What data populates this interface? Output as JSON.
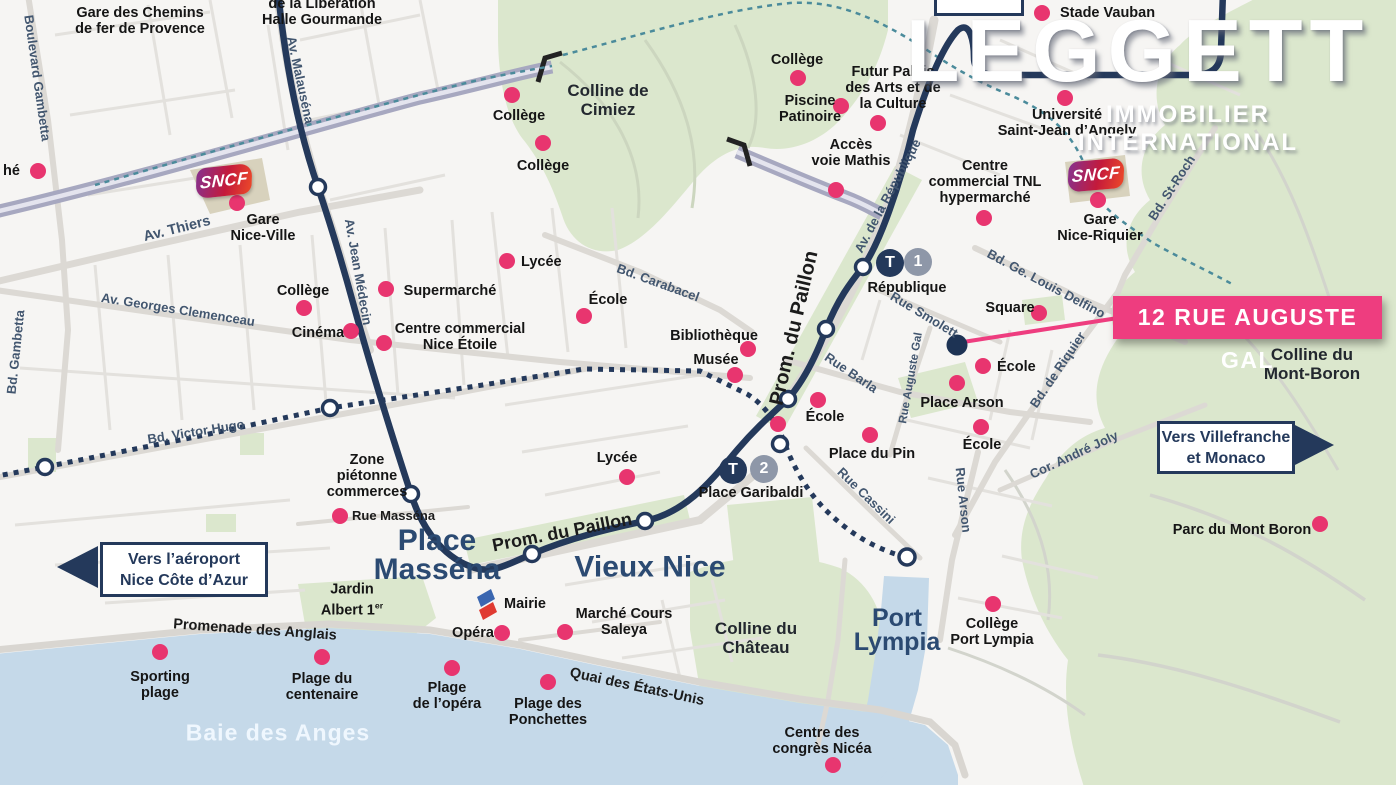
{
  "brand": {
    "logo": "LEGGETT",
    "tagline": "IMMOBILIER  INTERNATIONAL"
  },
  "callout": {
    "label": "12 RUE AUGUSTE GAL"
  },
  "direction_signs": [
    {
      "lines": [
        "Vers l’aéroport",
        "Nice Côte d’Azur"
      ],
      "arrow": "left"
    },
    {
      "lines": [
        "Vers Villefranche",
        "et Monaco"
      ],
      "arrow": "right"
    }
  ],
  "rail": [
    {
      "logo": "SNCF"
    },
    {
      "logo": "SNCF"
    }
  ],
  "tram_stations": [
    {
      "line_letter": "T",
      "line_number": "1",
      "name": "République",
      "badge_x": 890,
      "badge_y": 263,
      "num_x": 918,
      "num_y": 262,
      "label_x": 907,
      "label_y": 288
    },
    {
      "line_letter": "T",
      "line_number": "2",
      "name": "Place Garibaldi",
      "badge_x": 733,
      "badge_y": 470,
      "num_x": 764,
      "num_y": 469,
      "label_x": 751,
      "label_y": 493
    }
  ],
  "colors": {
    "dot_pink": "#e8356f",
    "callout_pink": "#ee3d7f",
    "navy": "#24395b",
    "badge_gray": "#8e97a8",
    "water": "#c5d9e9",
    "park_green": "#dbe7cd",
    "teal_dash": "#4b8b9b",
    "ribbon": "#a7a8c0"
  },
  "map_labels": {
    "pois": [
      {
        "lines": [
          "Gare des Chemins",
          "de fer de Provence"
        ],
        "x": 140,
        "y": 21
      },
      {
        "lines": [
          "de la Libération",
          "Halle Gourmande"
        ],
        "x": 322,
        "y": 12
      },
      {
        "lines": [
          "hé"
        ],
        "x": 3,
        "y": 171,
        "dot": [
          38,
          171
        ],
        "align": "left"
      },
      {
        "lines": [
          "Collège"
        ],
        "x": 519,
        "y": 116,
        "dot": [
          512,
          95
        ]
      },
      {
        "lines": [
          "Collège"
        ],
        "x": 543,
        "y": 166,
        "dot": [
          543,
          143
        ]
      },
      {
        "lines": [
          "Collège"
        ],
        "x": 797,
        "y": 60,
        "dot": [
          798,
          78
        ]
      },
      {
        "lines": [
          "Piscine",
          "Patinoire"
        ],
        "x": 810,
        "y": 109,
        "dot": [
          841,
          106
        ]
      },
      {
        "lines": [
          "Futur Palais",
          "des Arts et de",
          "la Culture"
        ],
        "x": 893,
        "y": 88,
        "dot": [
          878,
          123
        ]
      },
      {
        "lines": [
          "Accès",
          "voie Mathis"
        ],
        "x": 851,
        "y": 153,
        "dot": [
          836,
          190
        ]
      },
      {
        "lines": [
          "Stade Vauban"
        ],
        "x": 1060,
        "y": 13,
        "dot": [
          1042,
          13
        ],
        "align": "left"
      },
      {
        "lines": [
          "Université",
          "Saint-Jean d’Angely"
        ],
        "x": 1067,
        "y": 123,
        "dot": [
          1065,
          98
        ]
      },
      {
        "lines": [
          "Centre",
          "commercial TNL",
          "hypermarché"
        ],
        "x": 985,
        "y": 182,
        "dot": [
          984,
          218
        ]
      },
      {
        "lines": [
          "Gare",
          "Nice-Ville"
        ],
        "x": 263,
        "y": 228,
        "dot": [
          237,
          203
        ]
      },
      {
        "lines": [
          "Gare",
          "Nice-Riquier"
        ],
        "x": 1100,
        "y": 228,
        "dot": [
          1098,
          200
        ]
      },
      {
        "lines": [
          "Collège"
        ],
        "x": 303,
        "y": 291,
        "dot": [
          304,
          308
        ]
      },
      {
        "lines": [
          "Cinéma"
        ],
        "x": 318,
        "y": 333,
        "dot": [
          351,
          331
        ]
      },
      {
        "lines": [
          "Supermarché"
        ],
        "x": 450,
        "y": 291,
        "dot": [
          386,
          289
        ]
      },
      {
        "lines": [
          "Centre  commercial",
          "Nice Étoile"
        ],
        "x": 460,
        "y": 337,
        "dot": [
          384,
          343
        ]
      },
      {
        "lines": [
          "Lycée"
        ],
        "x": 521,
        "y": 262,
        "dot": [
          507,
          261
        ],
        "align": "left"
      },
      {
        "lines": [
          "École"
        ],
        "x": 608,
        "y": 300,
        "dot": [
          584,
          316
        ]
      },
      {
        "lines": [
          "Bibliothèque"
        ],
        "x": 714,
        "y": 336,
        "dot": [
          748,
          349
        ]
      },
      {
        "lines": [
          "Musée"
        ],
        "x": 716,
        "y": 360,
        "dot": [
          735,
          375
        ]
      },
      {
        "lines": [
          "Zone",
          "piétonne",
          "commerces"
        ],
        "x": 367,
        "y": 476
      },
      {
        "lines": [
          "Rue Masséna"
        ],
        "x": 352,
        "y": 516,
        "dot": [
          340,
          516
        ],
        "align": "left",
        "street": true
      },
      {
        "lines": [
          "Lycée"
        ],
        "x": 617,
        "y": 458,
        "dot": [
          627,
          477
        ]
      },
      {
        "lines": [
          "École"
        ],
        "x": 825,
        "y": 417,
        "dot": [
          818,
          400
        ]
      },
      {
        "lines": [
          "Place du Pin"
        ],
        "x": 872,
        "y": 454,
        "dot": [
          870,
          435
        ]
      },
      {
        "lines": [
          "École"
        ],
        "x": 997,
        "y": 367,
        "dot": [
          983,
          366
        ],
        "align": "left"
      },
      {
        "lines": [
          "Place Arson"
        ],
        "x": 962,
        "y": 403,
        "dot": [
          957,
          383
        ]
      },
      {
        "lines": [
          "École"
        ],
        "x": 982,
        "y": 445,
        "dot": [
          981,
          427
        ]
      },
      {
        "lines": [
          "Square"
        ],
        "x": 1010,
        "y": 308,
        "dot": [
          1039,
          313
        ]
      },
      {
        "lines": [
          "Mairie"
        ],
        "x": 525,
        "y": 604
      },
      {
        "lines": [
          "Opéra"
        ],
        "x": 473,
        "y": 633,
        "dot": [
          502,
          633
        ]
      },
      {
        "lines": [
          "Marché Cours",
          "Saleya"
        ],
        "x": 624,
        "y": 622,
        "dot": [
          565,
          632
        ]
      },
      {
        "lines": [
          "Collège",
          "Port Lympia"
        ],
        "x": 992,
        "y": 632,
        "dot": [
          993,
          604
        ]
      },
      {
        "lines": [
          "Centre des",
          "congrès Nicéa"
        ],
        "x": 822,
        "y": 741,
        "dot": [
          833,
          765
        ]
      },
      {
        "lines": [
          "Sporting",
          "plage"
        ],
        "x": 160,
        "y": 685,
        "dot": [
          160,
          652
        ]
      },
      {
        "lines": [
          "Plage du",
          "centenaire"
        ],
        "x": 322,
        "y": 687,
        "dot": [
          322,
          657
        ]
      },
      {
        "lines": [
          "Plage",
          "de l’opéra"
        ],
        "x": 447,
        "y": 696,
        "dot": [
          452,
          668
        ]
      },
      {
        "lines": [
          "Plage des",
          "Ponchettes"
        ],
        "x": 548,
        "y": 712,
        "dot": [
          548,
          682
        ]
      },
      {
        "lines": [
          "Jardin",
          "Albert 1er"
        ],
        "x": 352,
        "y": 600
      },
      {
        "lines": [
          "Parc du Mont Boron"
        ],
        "x": 1242,
        "y": 530,
        "dot": [
          1320,
          524
        ]
      }
    ],
    "streets": [
      {
        "text": "Boulevard Gambetta",
        "x": 37,
        "y": 78,
        "rot": 82
      },
      {
        "text": "Bd. Gambetta",
        "x": 16,
        "y": 352,
        "rot": -84
      },
      {
        "text": "Av. Malauséna",
        "x": 300,
        "y": 80,
        "rot": 78
      },
      {
        "text": "Av. Thiers",
        "x": 177,
        "y": 229,
        "rot": -14,
        "size": 14.5
      },
      {
        "text": "Av. Jean Médecin",
        "x": 358,
        "y": 272,
        "rot": 80
      },
      {
        "text": "Av.  Georges Clemenceau",
        "x": 178,
        "y": 310,
        "rot": 9
      },
      {
        "text": "Bd. Victor Hugo",
        "x": 196,
        "y": 432,
        "rot": -9
      },
      {
        "text": "Bd. Carabacel",
        "x": 658,
        "y": 283,
        "rot": 20
      },
      {
        "text": "Prom. du Paillon",
        "x": 794,
        "y": 328,
        "rot": -77,
        "size": 20,
        "dark": true
      },
      {
        "text": "Prom. du Paillon",
        "x": 562,
        "y": 532,
        "rot": -11,
        "size": 18,
        "dark": true
      },
      {
        "text": "Av. de la République",
        "x": 888,
        "y": 196,
        "rot": -62
      },
      {
        "text": "Rue Smolett",
        "x": 924,
        "y": 315,
        "rot": 31
      },
      {
        "text": "Rue Auguste Gal",
        "x": 911,
        "y": 378,
        "rot": -80,
        "size": 11.5
      },
      {
        "text": "Rue Barla",
        "x": 851,
        "y": 373,
        "rot": 34
      },
      {
        "text": "Bd. Ge. Louis Delfino",
        "x": 1046,
        "y": 284,
        "rot": 28
      },
      {
        "text": "Bd. de Riquier",
        "x": 1058,
        "y": 370,
        "rot": -56
      },
      {
        "text": "Bd. St-Roch",
        "x": 1172,
        "y": 188,
        "rot": -57
      },
      {
        "text": "Cor. André Joly",
        "x": 1074,
        "y": 455,
        "rot": -25
      },
      {
        "text": "Rue Cassini",
        "x": 866,
        "y": 496,
        "rot": 44
      },
      {
        "text": "Rue Arson",
        "x": 963,
        "y": 500,
        "rot": 84
      },
      {
        "text": "Promenade des Anglais",
        "x": 255,
        "y": 630,
        "rot": 4,
        "size": 14.5,
        "dark": true
      },
      {
        "text": "Quai des États-Unis",
        "x": 637,
        "y": 687,
        "rot": 12,
        "size": 14.5,
        "dark": true
      }
    ],
    "hills": [
      {
        "lines": [
          "Colline de",
          "Cimiez"
        ],
        "x": 608,
        "y": 100
      },
      {
        "lines": [
          "Colline du",
          "Château"
        ],
        "x": 756,
        "y": 638
      },
      {
        "lines": [
          "Colline du",
          "Mont-Boron"
        ],
        "x": 1312,
        "y": 364
      }
    ],
    "districts": [
      {
        "lines": [
          "Place",
          "Masséna"
        ],
        "x": 437,
        "y": 555,
        "size": 30
      },
      {
        "lines": [
          "Vieux Nice"
        ],
        "x": 650,
        "y": 567,
        "size": 30
      },
      {
        "lines": [
          "Port",
          "Lympia"
        ],
        "x": 897,
        "y": 630,
        "size": 25
      }
    ],
    "water": {
      "text": "Baie des Anges",
      "x": 278,
      "y": 733
    },
    "extra_dots": [
      [
        778,
        424
      ]
    ]
  }
}
